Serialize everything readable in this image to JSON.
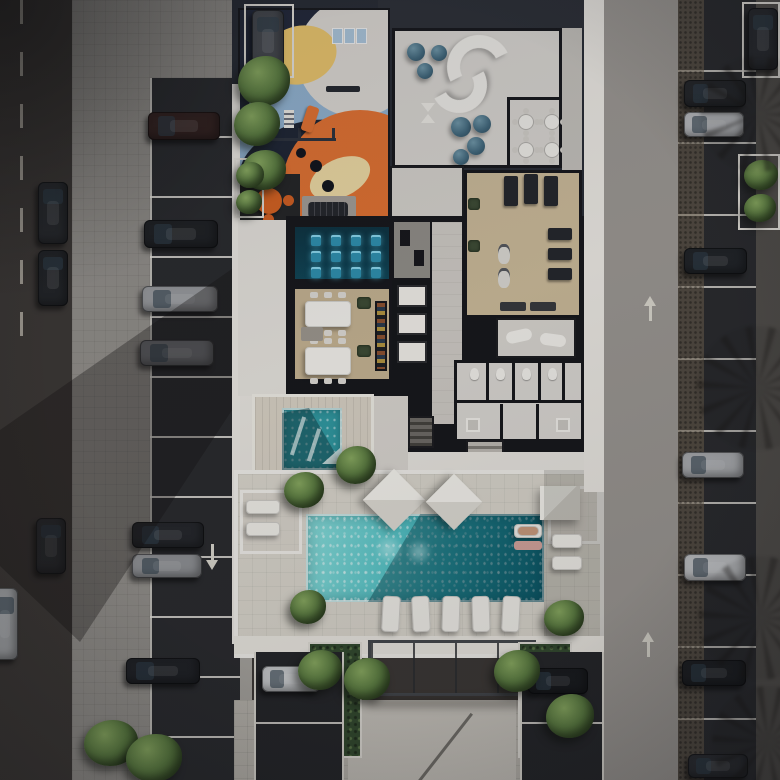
{
  "scene": {
    "description": "Dusk aerial 3D rendering of a residential amenity level: cut-away floor plan with cinema, dining room, lounge, gym and locker rooms, children's playground with colorful mural, plunge spa, large swimming pool with shade sails and loungers, entrance canopy, surrounded by streets and parking rows with cars",
    "regions": [
      "street-west",
      "sidewalk-west",
      "parking-west",
      "playground",
      "kids-table-nook",
      "lounge-room",
      "cafe-corner",
      "cinema-room",
      "dining-room",
      "elevator-bank",
      "corridor",
      "gym",
      "gym-annex",
      "locker-rooms",
      "stairs",
      "spa-terrace",
      "plunge-pool",
      "pool-deck",
      "swimming-pool",
      "cabana-west",
      "cabana-east",
      "shade-sails",
      "entrance-canopy",
      "hedges",
      "driveway",
      "parking-pad-west",
      "parking-pad-east",
      "sidewalk-east",
      "parking-east",
      "street-east"
    ],
    "counts": {
      "cars": 22,
      "trees": 17,
      "cinema_seats": 12,
      "ottoman_poufs": 7,
      "cafe_tables": 4,
      "pool_loungers": 10,
      "shade_sails": 3,
      "elevators": 3
    }
  },
  "palette": {
    "asphalt": "#3a3633",
    "parking": "#28292c",
    "sidewalk": "#908d88",
    "deck": "#d9d5cb",
    "wall": "#e9e6e0",
    "roof": "#262a32",
    "floor": "#d3d0ca",
    "tan": "#c3b190",
    "cinema": "#0c3240",
    "pool_light": "#8adfdc",
    "pool_dark": "#0d6f80",
    "spa": "#2f98a0",
    "mural_navy": "#202637",
    "mural_blue": "#8fb0cd",
    "mural_orange": "#df7030",
    "mural_yellow": "#e8c36a",
    "tree": "#5b7c40",
    "hedge": "#31482c",
    "shadow": "rgba(18,16,14,0.34)"
  },
  "sprites": [
    {
      "p": "left-zone",
      "c": "car h",
      "n": "car-west-1",
      "x": 148,
      "y": 112,
      "w": 72,
      "h": 28,
      "col": "#31201e"
    },
    {
      "p": "left-zone",
      "c": "car h",
      "n": "car-west-2",
      "x": 144,
      "y": 220,
      "w": 74,
      "h": 28,
      "col": "#1d1f22"
    },
    {
      "p": "left-zone",
      "c": "car h",
      "n": "car-west-3",
      "x": 142,
      "y": 286,
      "w": 76,
      "h": 26,
      "col": "#97999c"
    },
    {
      "p": "left-zone",
      "c": "car h",
      "n": "car-west-4",
      "x": 140,
      "y": 340,
      "w": 74,
      "h": 26,
      "col": "#6e7074"
    },
    {
      "p": "left-zone",
      "c": "car h",
      "n": "car-west-5",
      "x": 132,
      "y": 522,
      "w": 72,
      "h": 26,
      "col": "#232529"
    },
    {
      "p": "left-zone",
      "c": "car h",
      "n": "car-west-6",
      "x": 132,
      "y": 554,
      "w": 70,
      "h": 24,
      "col": "#8d8f92"
    },
    {
      "p": "left-zone",
      "c": "car h",
      "n": "car-west-7",
      "x": 126,
      "y": 658,
      "w": 74,
      "h": 26,
      "col": "#1e2024"
    },
    {
      "p": "left-zone",
      "c": "car v",
      "n": "car-street-1",
      "x": 38,
      "y": 182,
      "w": 30,
      "h": 62,
      "col": "#26282b"
    },
    {
      "p": "left-zone",
      "c": "car v",
      "n": "car-street-2",
      "x": 38,
      "y": 250,
      "w": 30,
      "h": 56,
      "col": "#202225"
    },
    {
      "p": "left-zone",
      "c": "car v",
      "n": "car-street-3",
      "x": 36,
      "y": 518,
      "w": 30,
      "h": 56,
      "col": "#2a2c2f"
    },
    {
      "p": "left-zone",
      "c": "car v",
      "n": "car-street-4",
      "x": -8,
      "y": 588,
      "w": 26,
      "h": 72,
      "col": "#9fa1a3"
    },
    {
      "c": "car v",
      "n": "car-stall-nw",
      "x": 252,
      "y": 10,
      "w": 32,
      "h": 62,
      "col": "#44474c"
    },
    {
      "c": "car h",
      "n": "car-east-1",
      "x": 684,
      "y": 80,
      "w": 62,
      "h": 27,
      "col": "#232528"
    },
    {
      "c": "car h",
      "n": "car-east-2",
      "x": 684,
      "y": 112,
      "w": 60,
      "h": 25,
      "col": "#b9bbbe"
    },
    {
      "c": "car h",
      "n": "car-east-3",
      "x": 684,
      "y": 248,
      "w": 63,
      "h": 26,
      "col": "#1f2226"
    },
    {
      "c": "car h",
      "n": "car-east-4",
      "x": 682,
      "y": 452,
      "w": 62,
      "h": 26,
      "col": "#a8aaad"
    },
    {
      "c": "car h",
      "n": "car-east-5",
      "x": 684,
      "y": 554,
      "w": 62,
      "h": 27,
      "col": "#c2c4c6"
    },
    {
      "c": "car h",
      "n": "car-east-6",
      "x": 682,
      "y": 660,
      "w": 64,
      "h": 26,
      "col": "#1b1d20"
    },
    {
      "c": "car h",
      "n": "car-east-7",
      "x": 688,
      "y": 754,
      "w": 60,
      "h": 24,
      "col": "#2a2c30"
    },
    {
      "c": "car v",
      "n": "car-stall-ne",
      "x": 748,
      "y": 8,
      "w": 30,
      "h": 62,
      "col": "#26282c"
    },
    {
      "c": "car h",
      "n": "car-pad-west",
      "x": 262,
      "y": 666,
      "w": 58,
      "h": 26,
      "col": "#c6c8ca"
    },
    {
      "c": "car h",
      "n": "car-pad-east",
      "x": 528,
      "y": 668,
      "w": 60,
      "h": 26,
      "col": "#17191c"
    },
    {
      "c": "tree",
      "n": "tree",
      "x": 238,
      "y": 56,
      "w": 52,
      "h": 50
    },
    {
      "c": "tree",
      "n": "tree",
      "x": 234,
      "y": 102,
      "w": 46,
      "h": 44
    },
    {
      "c": "tree",
      "n": "tree",
      "x": 242,
      "y": 150,
      "w": 44,
      "h": 40
    },
    {
      "c": "tree",
      "n": "tree",
      "x": 336,
      "y": 446,
      "w": 40,
      "h": 38
    },
    {
      "c": "tree",
      "n": "tree",
      "x": 284,
      "y": 472,
      "w": 40,
      "h": 36
    },
    {
      "c": "tree",
      "n": "tree",
      "x": 290,
      "y": 590,
      "w": 36,
      "h": 34
    },
    {
      "c": "tree",
      "n": "tree",
      "x": 544,
      "y": 600,
      "w": 40,
      "h": 36
    },
    {
      "c": "tree",
      "n": "tree",
      "x": 298,
      "y": 650,
      "w": 44,
      "h": 40
    },
    {
      "c": "tree",
      "n": "tree",
      "x": 344,
      "y": 658,
      "w": 46,
      "h": 42
    },
    {
      "c": "tree",
      "n": "tree",
      "x": 494,
      "y": 650,
      "w": 46,
      "h": 42
    },
    {
      "c": "tree",
      "n": "tree",
      "x": 546,
      "y": 694,
      "w": 48,
      "h": 44
    },
    {
      "c": "tree",
      "n": "tree",
      "x": 84,
      "y": 720,
      "w": 54,
      "h": 46
    },
    {
      "c": "tree",
      "n": "tree",
      "x": 126,
      "y": 734,
      "w": 56,
      "h": 48
    },
    {
      "c": "tree",
      "n": "tree",
      "x": 744,
      "y": 160,
      "w": 34,
      "h": 30
    },
    {
      "c": "tree",
      "n": "tree",
      "x": 744,
      "y": 194,
      "w": 32,
      "h": 28
    },
    {
      "c": "tree",
      "n": "tree",
      "x": 236,
      "y": 162,
      "w": 28,
      "h": 26
    },
    {
      "c": "tree",
      "n": "tree",
      "x": 236,
      "y": 190,
      "w": 26,
      "h": 24
    },
    {
      "p": "lounge-room",
      "c": "pouf",
      "n": "ottoman",
      "x": 12,
      "y": 12,
      "w": 18,
      "h": 18
    },
    {
      "p": "lounge-room",
      "c": "pouf",
      "n": "ottoman",
      "x": 36,
      "y": 14,
      "w": 16,
      "h": 16
    },
    {
      "p": "lounge-room",
      "c": "pouf",
      "n": "ottoman",
      "x": 22,
      "y": 32,
      "w": 16,
      "h": 16
    },
    {
      "p": "lounge-room",
      "c": "pouf",
      "n": "ottoman",
      "x": 56,
      "y": 86,
      "w": 20,
      "h": 20
    },
    {
      "p": "lounge-room",
      "c": "pouf",
      "n": "ottoman",
      "x": 78,
      "y": 84,
      "w": 18,
      "h": 18
    },
    {
      "p": "lounge-room",
      "c": "pouf",
      "n": "ottoman",
      "x": 72,
      "y": 106,
      "w": 18,
      "h": 18
    },
    {
      "p": "lounge-room",
      "c": "pouf",
      "n": "ottoman",
      "x": 58,
      "y": 118,
      "w": 16,
      "h": 16
    },
    {
      "p": "lounge-room",
      "c": "cafe-table",
      "n": "cafe-table",
      "x": 124,
      "y": 84,
      "w": 14,
      "h": 14
    },
    {
      "p": "lounge-room",
      "c": "cafe-table",
      "n": "cafe-table",
      "x": 150,
      "y": 84,
      "w": 14,
      "h": 14
    },
    {
      "p": "lounge-room",
      "c": "cafe-table",
      "n": "cafe-table",
      "x": 124,
      "y": 112,
      "w": 14,
      "h": 14
    },
    {
      "p": "lounge-room",
      "c": "cafe-table",
      "n": "cafe-table",
      "x": 150,
      "y": 112,
      "w": 14,
      "h": 14
    },
    {
      "p": "cinema-room",
      "c": "cinema-seat",
      "n": "cinema-seat",
      "x": 16,
      "y": 8,
      "w": 10,
      "h": 11
    },
    {
      "p": "cinema-room",
      "c": "cinema-seat",
      "n": "cinema-seat",
      "x": 36,
      "y": 8,
      "w": 10,
      "h": 11
    },
    {
      "p": "cinema-room",
      "c": "cinema-seat",
      "n": "cinema-seat",
      "x": 56,
      "y": 8,
      "w": 10,
      "h": 11
    },
    {
      "p": "cinema-room",
      "c": "cinema-seat",
      "n": "cinema-seat",
      "x": 76,
      "y": 8,
      "w": 10,
      "h": 11
    },
    {
      "p": "cinema-room",
      "c": "cinema-seat",
      "n": "cinema-seat",
      "x": 16,
      "y": 24,
      "w": 10,
      "h": 11
    },
    {
      "p": "cinema-room",
      "c": "cinema-seat",
      "n": "cinema-seat",
      "x": 36,
      "y": 24,
      "w": 10,
      "h": 11
    },
    {
      "p": "cinema-room",
      "c": "cinema-seat",
      "n": "cinema-seat",
      "x": 56,
      "y": 24,
      "w": 10,
      "h": 11
    },
    {
      "p": "cinema-room",
      "c": "cinema-seat",
      "n": "cinema-seat",
      "x": 76,
      "y": 24,
      "w": 10,
      "h": 11
    },
    {
      "p": "cinema-room",
      "c": "cinema-seat",
      "n": "cinema-seat",
      "x": 16,
      "y": 40,
      "w": 10,
      "h": 11
    },
    {
      "p": "cinema-room",
      "c": "cinema-seat",
      "n": "cinema-seat",
      "x": 36,
      "y": 40,
      "w": 10,
      "h": 11
    },
    {
      "p": "cinema-room",
      "c": "cinema-seat",
      "n": "cinema-seat",
      "x": 56,
      "y": 40,
      "w": 10,
      "h": 11
    },
    {
      "p": "cinema-room",
      "c": "cinema-seat",
      "n": "cinema-seat",
      "x": 76,
      "y": 40,
      "w": 10,
      "h": 11
    },
    {
      "c": "lounger",
      "n": "pool-lounger",
      "x": 382,
      "y": 596,
      "w": 18,
      "h": 36,
      "r": 3
    },
    {
      "c": "lounger",
      "n": "pool-lounger",
      "x": 412,
      "y": 596,
      "w": 18,
      "h": 36,
      "r": -3
    },
    {
      "c": "lounger",
      "n": "pool-lounger",
      "x": 442,
      "y": 596,
      "w": 18,
      "h": 36,
      "r": 2
    },
    {
      "c": "lounger",
      "n": "pool-lounger",
      "x": 472,
      "y": 596,
      "w": 18,
      "h": 36,
      "r": -2
    },
    {
      "c": "lounger",
      "n": "pool-lounger",
      "x": 502,
      "y": 596,
      "w": 18,
      "h": 36,
      "r": 3
    },
    {
      "c": "lounger",
      "n": "cabana-lounger",
      "x": 246,
      "y": 500,
      "w": 34,
      "h": 14
    },
    {
      "c": "lounger",
      "n": "cabana-lounger",
      "x": 246,
      "y": 522,
      "w": 34,
      "h": 14
    },
    {
      "c": "lounger",
      "n": "cabana-lounger",
      "x": 552,
      "y": 534,
      "w": 30,
      "h": 14
    },
    {
      "c": "lounger",
      "n": "cabana-lounger",
      "x": 552,
      "y": 556,
      "w": 30,
      "h": 14
    },
    {
      "c": "lounger",
      "n": "cabana-lounger",
      "x": 514,
      "y": 524,
      "w": 28,
      "h": 14
    },
    {
      "c": "person",
      "n": "sunbather",
      "x": 518,
      "y": 527,
      "w": 20,
      "h": 8,
      "col": "#c99a7c"
    },
    {
      "c": "towel",
      "n": "towel",
      "x": 514,
      "y": 541,
      "w": 28,
      "h": 9,
      "col": "#d4a49c"
    },
    {
      "c": "fronds",
      "n": "palm-shadow",
      "x": 700,
      "y": 56,
      "w": 116,
      "h": 116
    },
    {
      "c": "fronds",
      "n": "palm-shadow",
      "x": 696,
      "y": 326,
      "w": 124,
      "h": 124
    },
    {
      "c": "fronds",
      "n": "palm-shadow",
      "x": 698,
      "y": 556,
      "w": 124,
      "h": 124
    },
    {
      "c": "fronds",
      "n": "palm-shadow",
      "x": 712,
      "y": 686,
      "w": 112,
      "h": 112
    },
    {
      "c": "arrow-down",
      "n": "lane-arrow",
      "x": 206,
      "y": 544,
      "w": 12,
      "h": 26
    },
    {
      "c": "arrow-up",
      "n": "lane-arrow",
      "x": 644,
      "y": 296,
      "w": 12,
      "h": 26
    },
    {
      "c": "arrow-up",
      "n": "lane-arrow",
      "x": 642,
      "y": 632,
      "w": 12,
      "h": 26
    }
  ]
}
